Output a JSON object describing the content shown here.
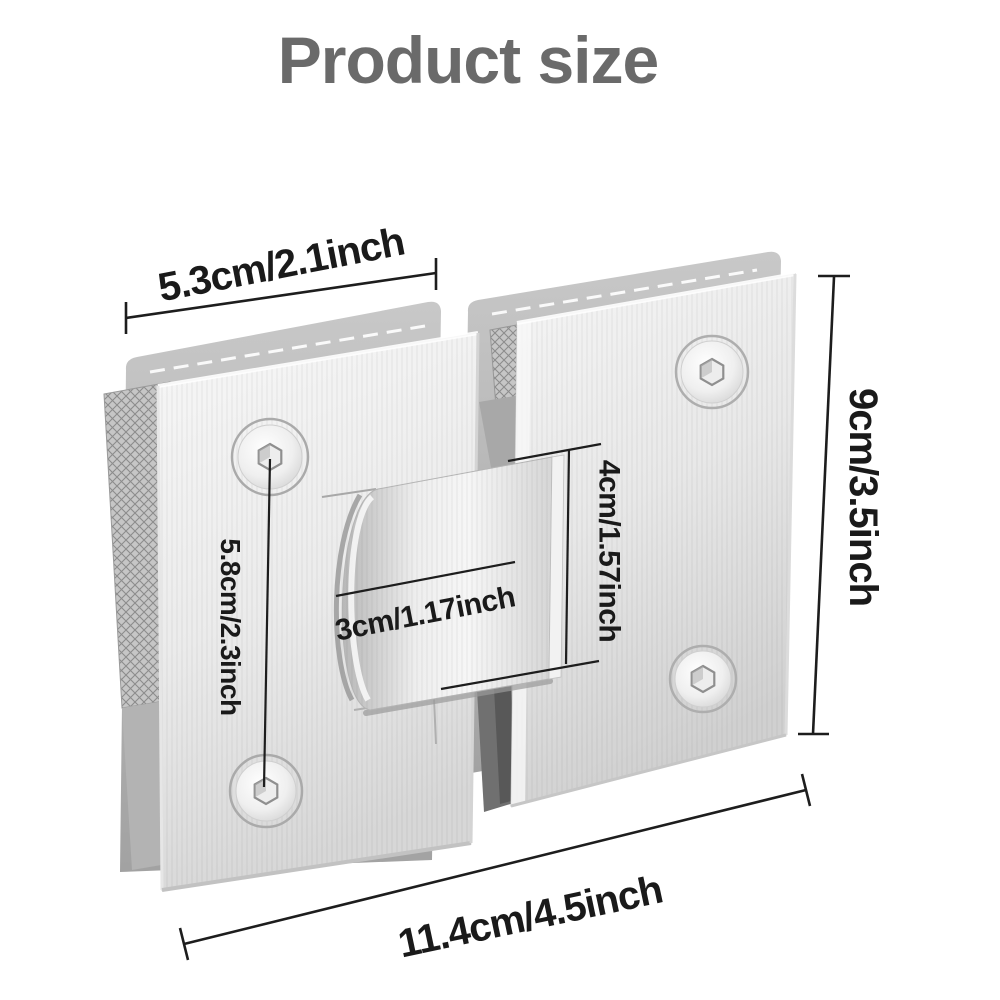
{
  "title": "Product size",
  "dimensions": {
    "plate_width": "5.3cm/2.1inch",
    "overall_width": "11.4cm/4.5inch",
    "overall_height": "9cm/3.5inch",
    "screw_spacing": "5.8cm/2.3inch",
    "hinge_block_height": "4cm/1.57inch",
    "hinge_block_width": "3cm/1.17inch"
  },
  "colors": {
    "background": "#ffffff",
    "title_text": "#6a6a6a",
    "dimension_text": "#1a1a1a",
    "dimension_line": "#1d1d1d",
    "steel_light": "#f5f5f5",
    "steel_mid": "#dcdcdc",
    "steel_shadow": "#9c9c9c",
    "gasket_gray": "#b0b0b0",
    "gap_dark": "#6f6f6f"
  }
}
